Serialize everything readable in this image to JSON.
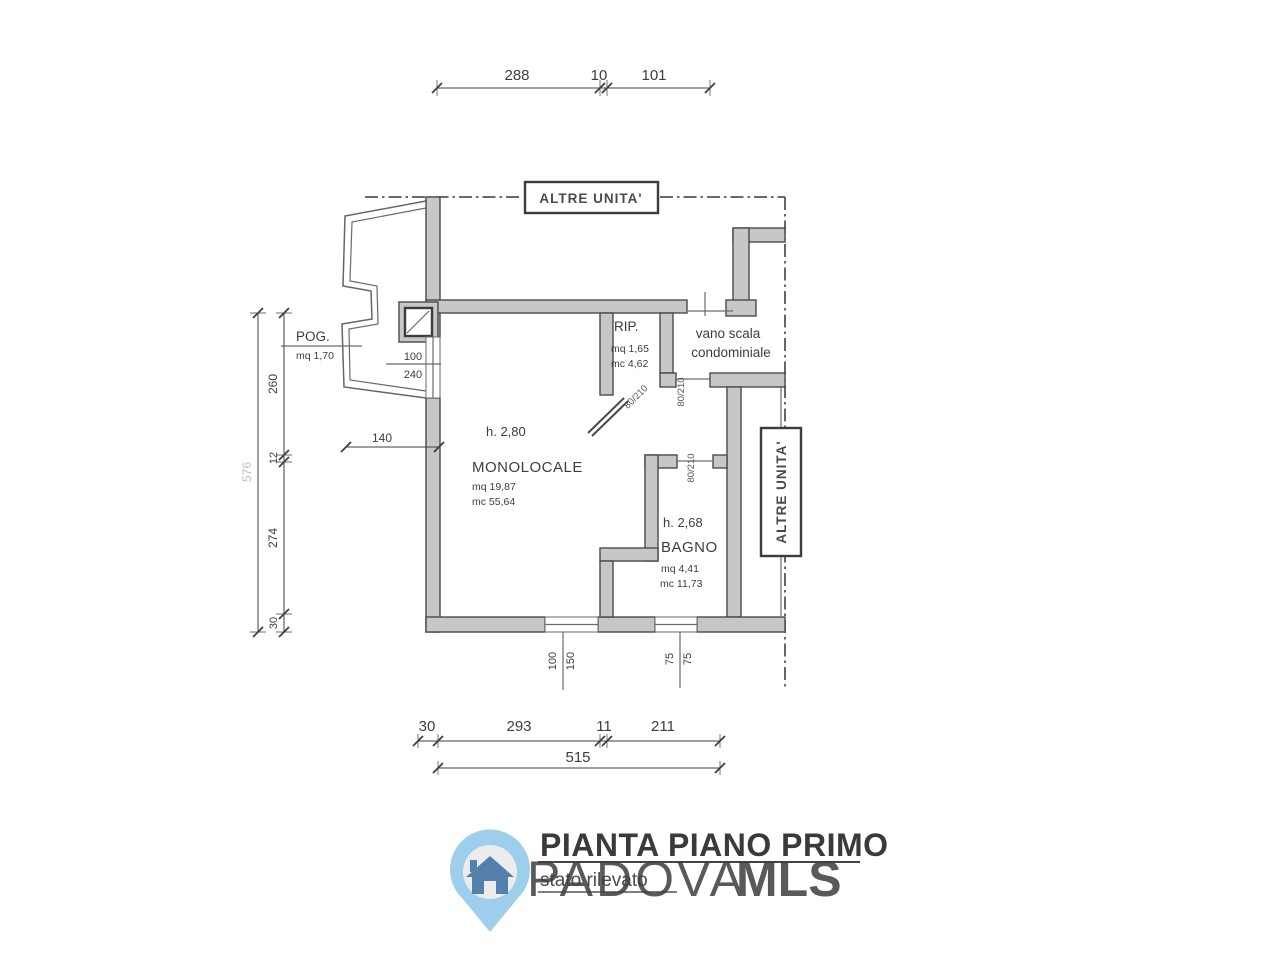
{
  "plan": {
    "boundary_labels": {
      "altre_unita_top": "ALTRE UNITA'",
      "altre_unita_right": "ALTRE UNITA'"
    },
    "rooms": {
      "monolocale": {
        "height": "h. 2,80",
        "name": "MONOLOCALE",
        "area": "mq 19,87",
        "volume": "mc 55,64"
      },
      "bagno": {
        "height": "h. 2,68",
        "name": "BAGNO",
        "area": "mq  4,41",
        "volume": "mc 11,73"
      },
      "rip": {
        "name": "RIP.",
        "area": "mq 1,65",
        "volume": "mc 4,62"
      },
      "pog": {
        "name": "POG.",
        "area": "mq 1,70"
      },
      "vano_scala": {
        "line1": "vano scala",
        "line2": "condominiale"
      }
    },
    "doors": {
      "rip_door": "80/210",
      "entrance_door": "80/210",
      "bagno_door": "80/210"
    },
    "windows": {
      "left": {
        "width": "100",
        "height": "240"
      },
      "bottom_left": {
        "width": "100",
        "height": "150"
      },
      "bottom_right": {
        "width": "75",
        "height": "75"
      }
    },
    "dims": {
      "top": {
        "d1": "288",
        "d2": "10",
        "d3": "101"
      },
      "left": {
        "total": "576",
        "d1": "260",
        "d2": "12",
        "d3": "274",
        "d4": "30"
      },
      "bottom": {
        "d1": "30",
        "d2": "293",
        "d3": "11",
        "d4": "211",
        "total": "515"
      },
      "interior": {
        "d140": "140"
      }
    }
  },
  "title": {
    "main": "PIANTA PIANO PRIMO",
    "sub": "stato rilevato"
  },
  "watermark": {
    "brand_light": "PADOVA",
    "brand_bold": "MLS",
    "light_color": "#8cc6e8",
    "bold_color": "#2d6ca7"
  },
  "logo": {
    "pin_color": "#8cc6e8",
    "inner_color": "#e9e9e9",
    "house_color": "#38699f"
  }
}
